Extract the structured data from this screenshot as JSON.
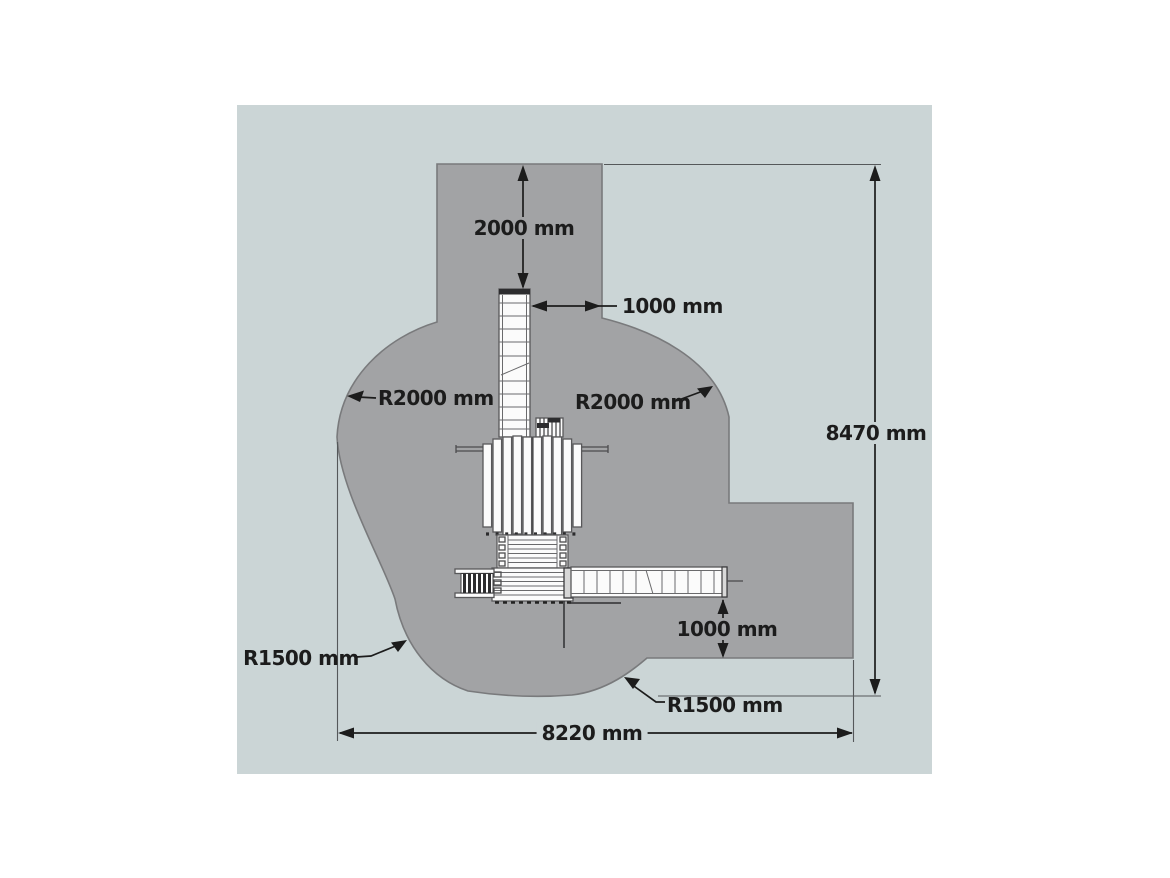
{
  "diagram": {
    "type": "playground-safety-zone-plan",
    "labels": {
      "top_clearance": "2000 mm",
      "slide_clearance": "1000 mm",
      "radius_top_left": "R2000 mm",
      "radius_top_right": "R2000 mm",
      "overall_depth": "8470 mm",
      "bridge_clearance": "1000 mm",
      "radius_bottom_left": "R1500 mm",
      "radius_bottom_right": "R1500 mm",
      "overall_width": "8220 mm"
    }
  },
  "colors": {
    "panel": "#cbd5d6",
    "zone": "#a2a3a5",
    "zone_outline": "#797a7c",
    "ink": "#1c1c1c",
    "structure_white": "#fbfbfb"
  }
}
